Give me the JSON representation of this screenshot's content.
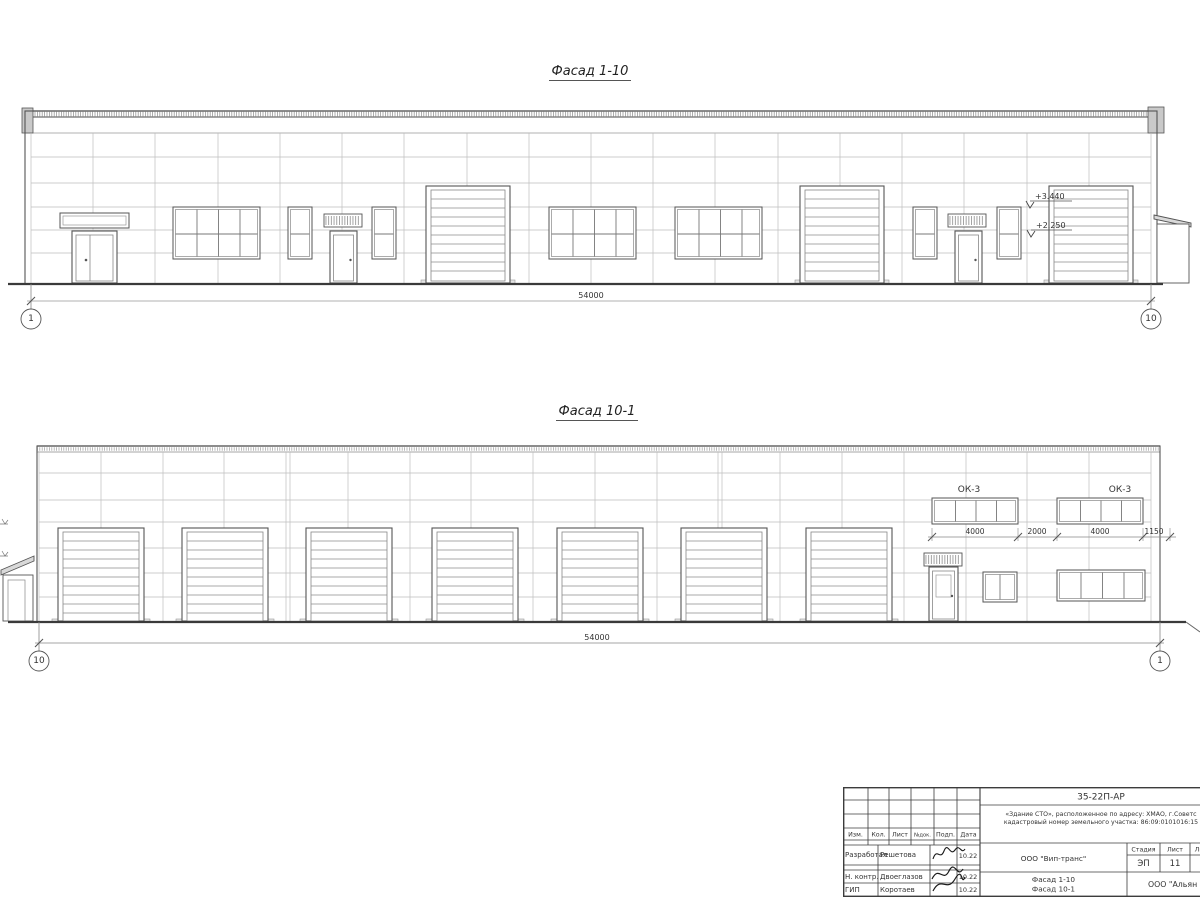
{
  "facade_top": {
    "title": "Фасад 1-10",
    "total_dim": "54000",
    "axis_left": "1",
    "axis_right": "10",
    "elev_upper": "+3.440",
    "elev_lower": "+2.250"
  },
  "facade_bottom": {
    "title": "Фасад 10-1",
    "total_dim": "54000",
    "axis_left": "10",
    "axis_right": "1",
    "window_mark_left": "ОК-3",
    "window_mark_right": "ОК-3",
    "dims": {
      "d1": "4000",
      "d2": "2000",
      "d3": "4000",
      "d4": "1150"
    }
  },
  "title_block": {
    "doc_number": "35-22П-АР",
    "object_line1": "«Здание СТО», расположенное по адресу: ХМАО, г.Советс",
    "object_line2": "кадастровый номер земельного участка: 86:09:0101016:15",
    "change_header": {
      "izm": "Изм.",
      "kol": "Кол.",
      "list": "Лист",
      "ndok": "№док.",
      "podp": "Подп.",
      "data": "Дата"
    },
    "rows": [
      {
        "role": "Разработал",
        "name": "Решетова",
        "date": "10.22"
      },
      {
        "role": "Н. контр.",
        "name": "Двоеглазов",
        "date": "10.22"
      },
      {
        "role": "ГИП",
        "name": "Коротаев",
        "date": "10.22"
      }
    ],
    "company": "ООО \"Вип-транс\"",
    "stage_header": {
      "stage": "Стадия",
      "sheet": "Лист",
      "sheets": "Ли"
    },
    "stage_value": "ЭП",
    "sheet_value": "11",
    "sheet_title_line1": "Фасад 1-10",
    "sheet_title_line2": "Фасад 10-1",
    "firm": "ООО \"Альян",
    "colors": {
      "line": "#555555",
      "grid": "#bdbdbd",
      "heavy": "#3a3a3a"
    }
  }
}
